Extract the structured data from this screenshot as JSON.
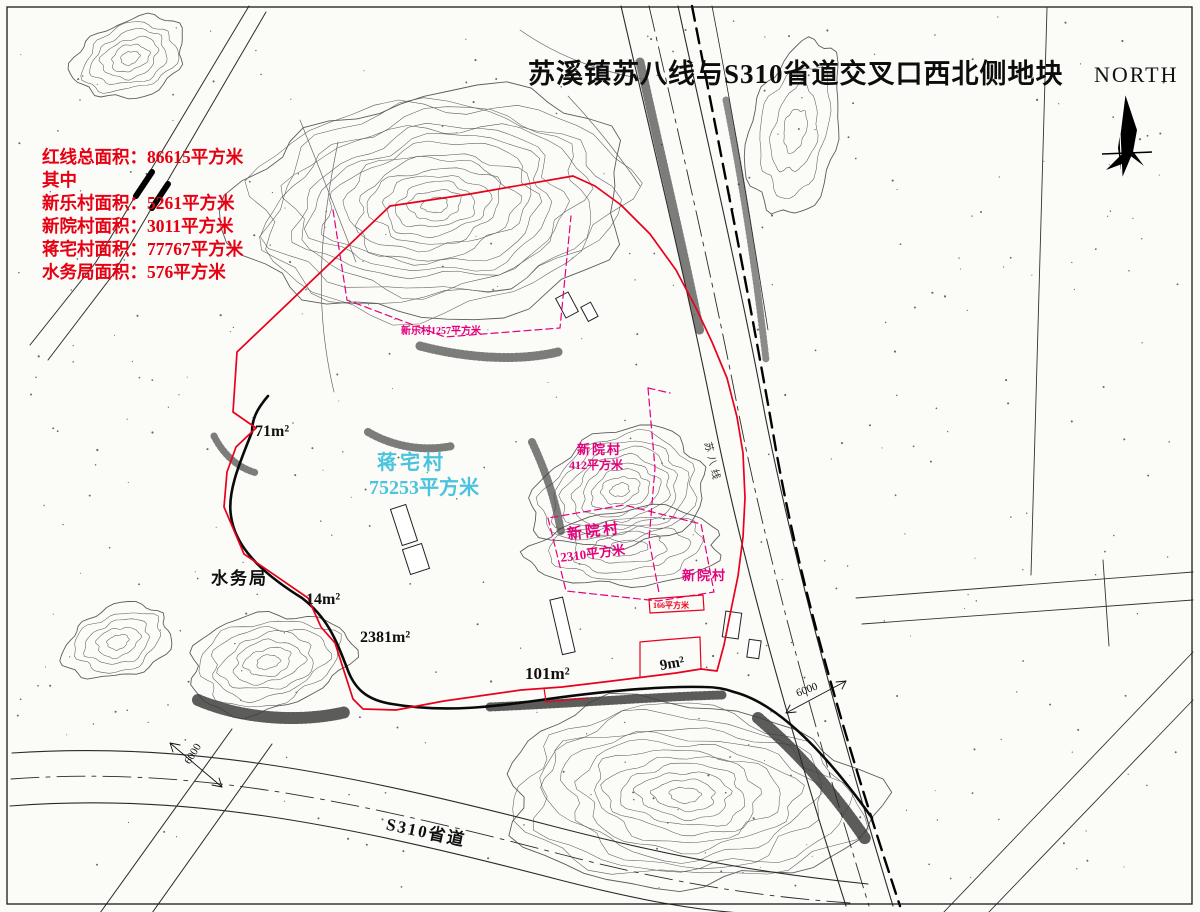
{
  "title": "苏溪镇苏八线与S310省道交叉口西北侧地块",
  "compass": {
    "label": "NORTH"
  },
  "legend": {
    "lines": [
      "红线总面积：86615平方米",
      "其中",
      "新乐村面积：5261平方米",
      "新院村面积：3011平方米",
      "蒋宅村面积：77767平方米",
      "水务局面积：576平方米"
    ]
  },
  "parcels": {
    "jiangzhai": {
      "name": "蒋宅村",
      "area": "75253平方米"
    },
    "xinle_strip": {
      "label": "新乐村1257平方米"
    },
    "xinyuan_mid": {
      "name": "新院村",
      "area": "412平方米"
    },
    "xinyuan_hill": {
      "name": "新院村",
      "area": "2310平方米"
    },
    "xinyuan_east": {
      "name": "新院村"
    },
    "small_166": {
      "label": "166平方米"
    },
    "shuiwuju": {
      "name": "水务局"
    }
  },
  "area_marks": {
    "m71": "71m²",
    "m14": "14m²",
    "m2381": "2381m²",
    "m101": "101m²",
    "m9": "9m²"
  },
  "roads": {
    "s310": "S310省道",
    "suba": "苏八线"
  },
  "dimensions": {
    "left": "6000",
    "right": "6000"
  },
  "colors": {
    "boundary_red": "#e8001c",
    "parcel_magenta": "#e5007d",
    "village_cyan": "#4ac3dc",
    "contour_gray": "#5c5c5c"
  }
}
